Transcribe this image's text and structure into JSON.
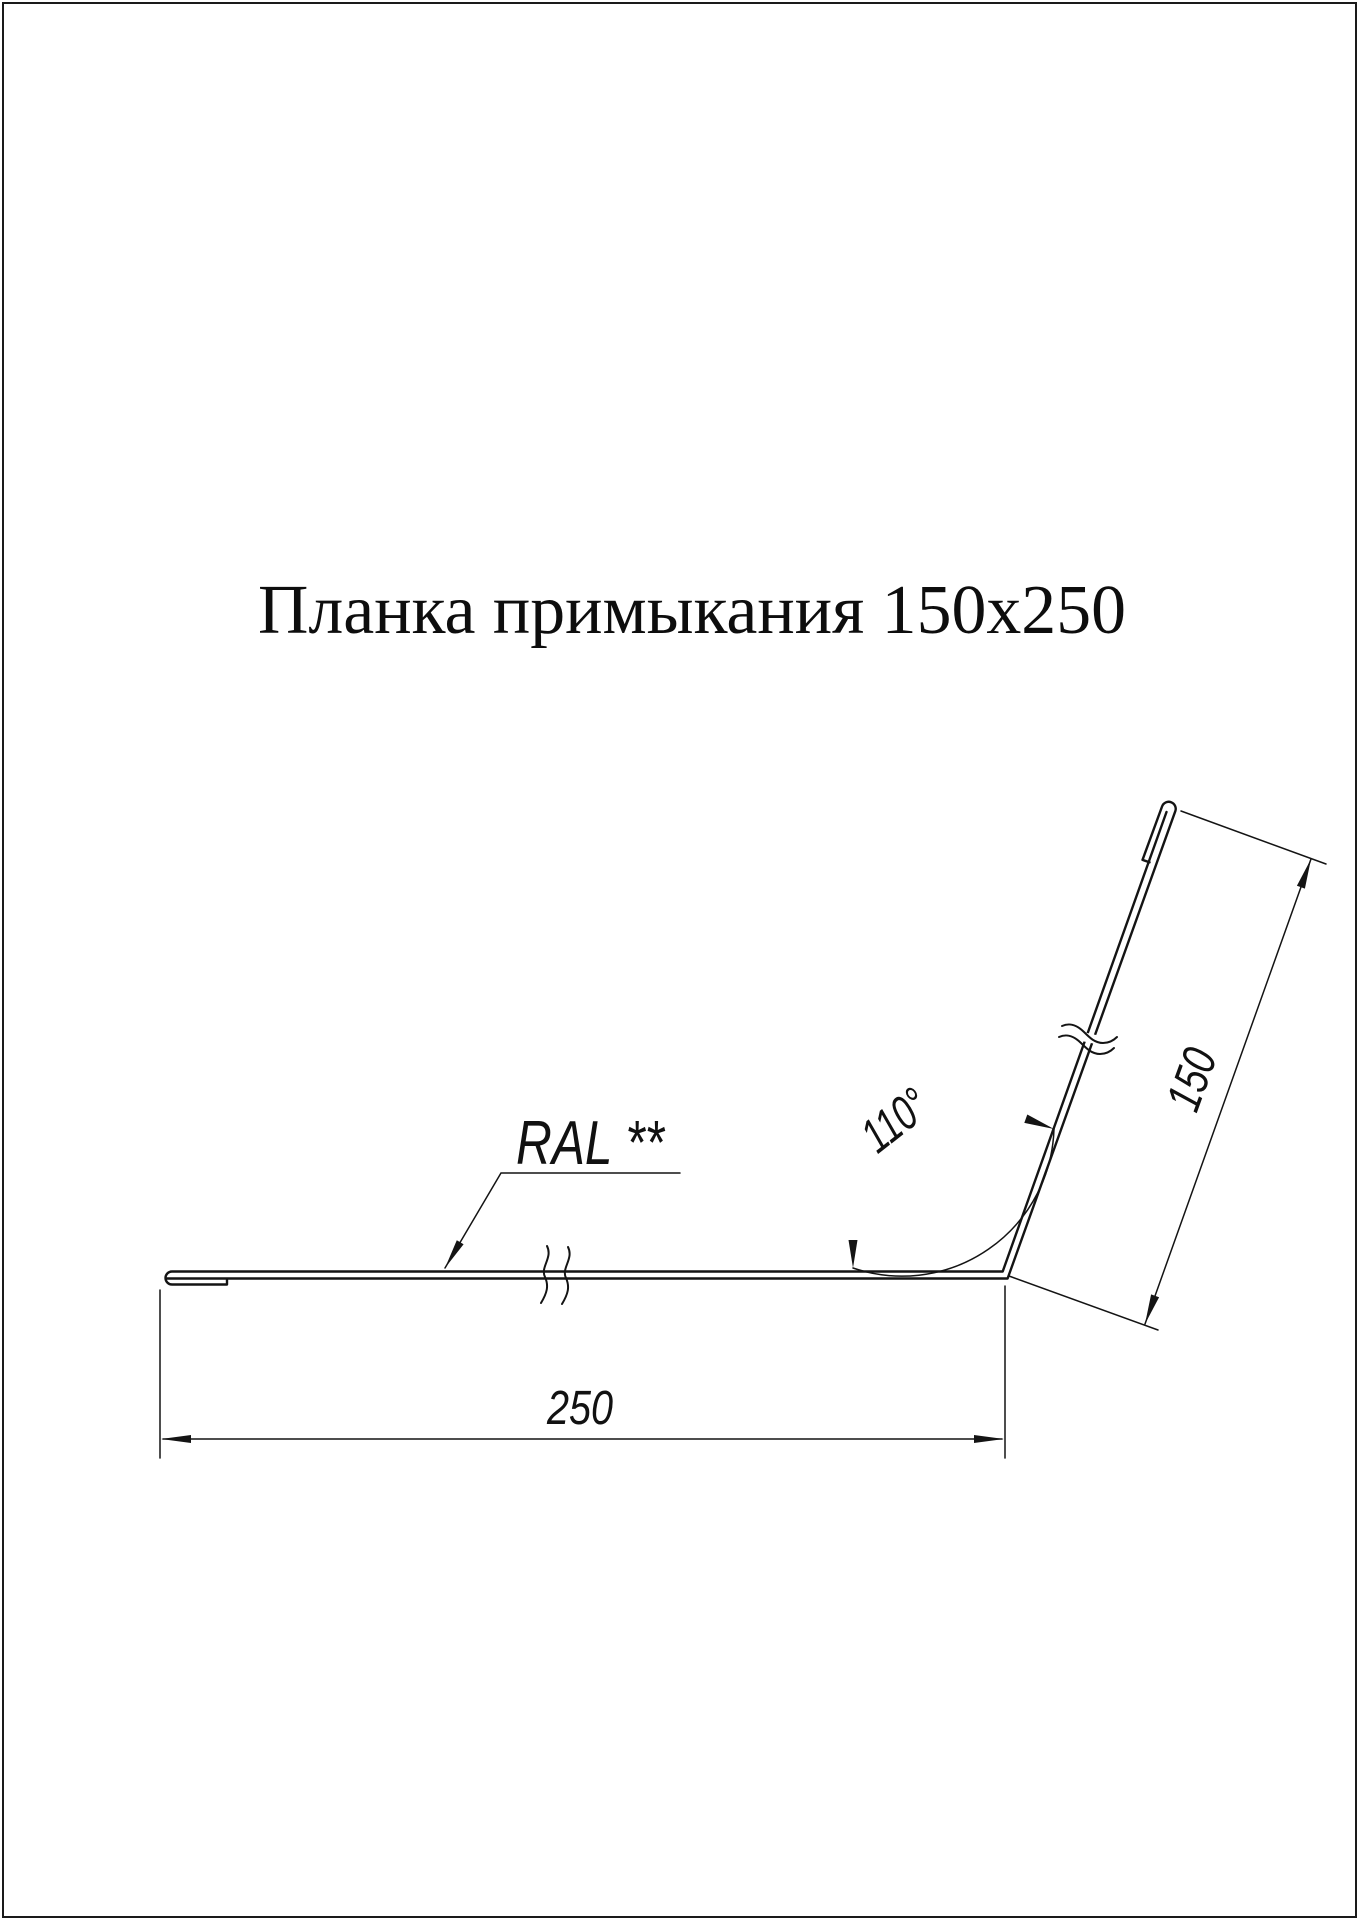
{
  "page": {
    "background": "#ffffff",
    "border_color": "#1a1a1a"
  },
  "title": {
    "text": "Планка примыкания 150x250"
  },
  "drawing": {
    "line_color": "#141414",
    "labels": {
      "material": "RAL **",
      "width": "250",
      "height": "150",
      "angle": "110°"
    }
  }
}
